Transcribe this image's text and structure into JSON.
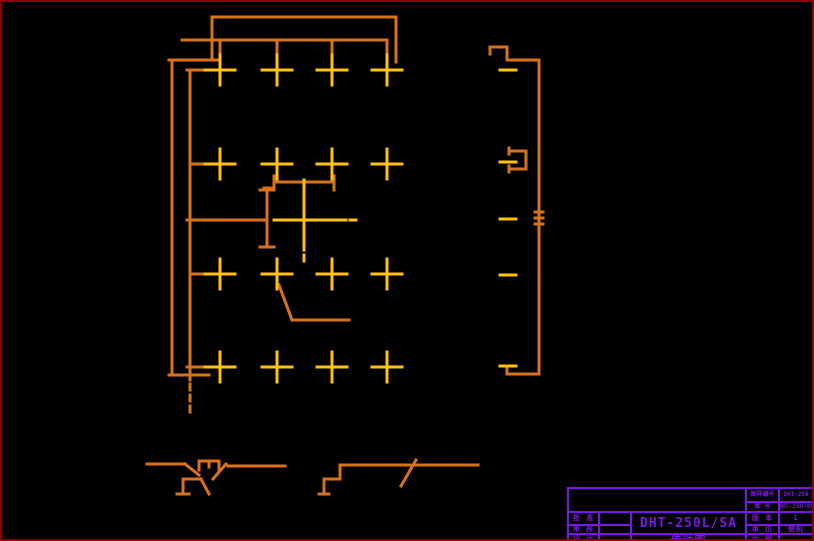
{
  "colors": {
    "background": "#000000",
    "frame": "#8B0000",
    "line_orange": "#D8721C",
    "marker_yellow": "#FFC20E",
    "block_purple": "#7B16E6"
  },
  "title_block": {
    "doc_no_label": "图样编号",
    "doc_no": "DHT-250",
    "dwg_no_label": "图 号",
    "dwg_no": "DHT-250-00",
    "approve_label": "批 准",
    "check_label": "审 核",
    "design_label": "设 计",
    "model": "DHT-250L/SA",
    "drawing_title": "传动图",
    "version_label": "版 本",
    "version": "1",
    "unit_label": "单 位",
    "unit": "整机",
    "scale_label": "比 例",
    "scale": ""
  },
  "drawing": {
    "stroke_width": 3,
    "cross_arm": 15,
    "cross_centers": [
      [
        218,
        68
      ],
      [
        275,
        68
      ],
      [
        330,
        68
      ],
      [
        385,
        68
      ],
      [
        218,
        162
      ],
      [
        275,
        162
      ],
      [
        330,
        162
      ],
      [
        385,
        162
      ],
      [
        218,
        272
      ],
      [
        275,
        272
      ],
      [
        330,
        272
      ],
      [
        385,
        272
      ],
      [
        218,
        365
      ],
      [
        275,
        365
      ],
      [
        330,
        365
      ],
      [
        385,
        365
      ]
    ],
    "orange_lines": [
      [
        210,
        15,
        394,
        15
      ],
      [
        210,
        15,
        210,
        58
      ],
      [
        394,
        15,
        394,
        60
      ],
      [
        180,
        38,
        385,
        38
      ],
      [
        218,
        38,
        218,
        53
      ],
      [
        275,
        38,
        275,
        57
      ],
      [
        330,
        38,
        330,
        57
      ],
      [
        385,
        38,
        385,
        57
      ],
      [
        167,
        58,
        218,
        58
      ],
      [
        170,
        58,
        170,
        373
      ],
      [
        188,
        68,
        188,
        378
      ],
      [
        185,
        68,
        206,
        68
      ],
      [
        188,
        162,
        233,
        162
      ],
      [
        185,
        218,
        265,
        218
      ],
      [
        188,
        272,
        210,
        272
      ],
      [
        185,
        365,
        207,
        365
      ],
      [
        167,
        373,
        207,
        373
      ],
      [
        272,
        180,
        332,
        180
      ],
      [
        272,
        174,
        272,
        188
      ],
      [
        332,
        174,
        332,
        188
      ],
      [
        262,
        186,
        272,
        186
      ],
      [
        265,
        188,
        265,
        245
      ],
      [
        258,
        188,
        272,
        188
      ],
      [
        258,
        245,
        272,
        245
      ],
      [
        277,
        283,
        290,
        318
      ],
      [
        290,
        318,
        347,
        318
      ],
      [
        488,
        45,
        488,
        52
      ],
      [
        488,
        45,
        505,
        45
      ],
      [
        505,
        45,
        505,
        58
      ],
      [
        505,
        58,
        537,
        58
      ],
      [
        537,
        58,
        537,
        372
      ],
      [
        505,
        372,
        537,
        372
      ],
      [
        505,
        366,
        505,
        372
      ],
      [
        507,
        149,
        524,
        149
      ],
      [
        524,
        149,
        524,
        167
      ],
      [
        507,
        167,
        524,
        167
      ],
      [
        507,
        146,
        507,
        152
      ],
      [
        507,
        164,
        507,
        170
      ],
      [
        533,
        210,
        541,
        210
      ],
      [
        533,
        216,
        541,
        216
      ],
      [
        533,
        222,
        541,
        222
      ],
      [
        145,
        462,
        183,
        462
      ],
      [
        183,
        462,
        197,
        473
      ],
      [
        197,
        459,
        217,
        459
      ],
      [
        197,
        459,
        197,
        468
      ],
      [
        207,
        459,
        207,
        465
      ],
      [
        217,
        459,
        217,
        468
      ],
      [
        224,
        462,
        211,
        477
      ],
      [
        226,
        464,
        283,
        464
      ],
      [
        181,
        477,
        181,
        492
      ],
      [
        175,
        492,
        187,
        492
      ],
      [
        181,
        477,
        199,
        477
      ],
      [
        199,
        477,
        207,
        492
      ],
      [
        322,
        477,
        322,
        492
      ],
      [
        317,
        492,
        327,
        492
      ],
      [
        322,
        477,
        338,
        477
      ],
      [
        338,
        463,
        338,
        477
      ],
      [
        338,
        463,
        408,
        463
      ],
      [
        414,
        458,
        399,
        484
      ],
      [
        412,
        463,
        476,
        463
      ],
      [
        188,
        382,
        188,
        388
      ],
      [
        188,
        393,
        188,
        399
      ],
      [
        188,
        404,
        188,
        410
      ]
    ],
    "yellow_lines": [
      [
        272,
        218,
        344,
        218
      ],
      [
        302,
        178,
        302,
        248
      ],
      [
        302,
        253,
        302,
        259
      ],
      [
        348,
        218,
        354,
        218
      ],
      [
        498,
        68,
        514,
        68
      ],
      [
        498,
        160,
        514,
        160
      ],
      [
        498,
        217,
        514,
        217
      ],
      [
        498,
        273,
        514,
        273
      ],
      [
        498,
        364,
        514,
        364
      ]
    ]
  }
}
